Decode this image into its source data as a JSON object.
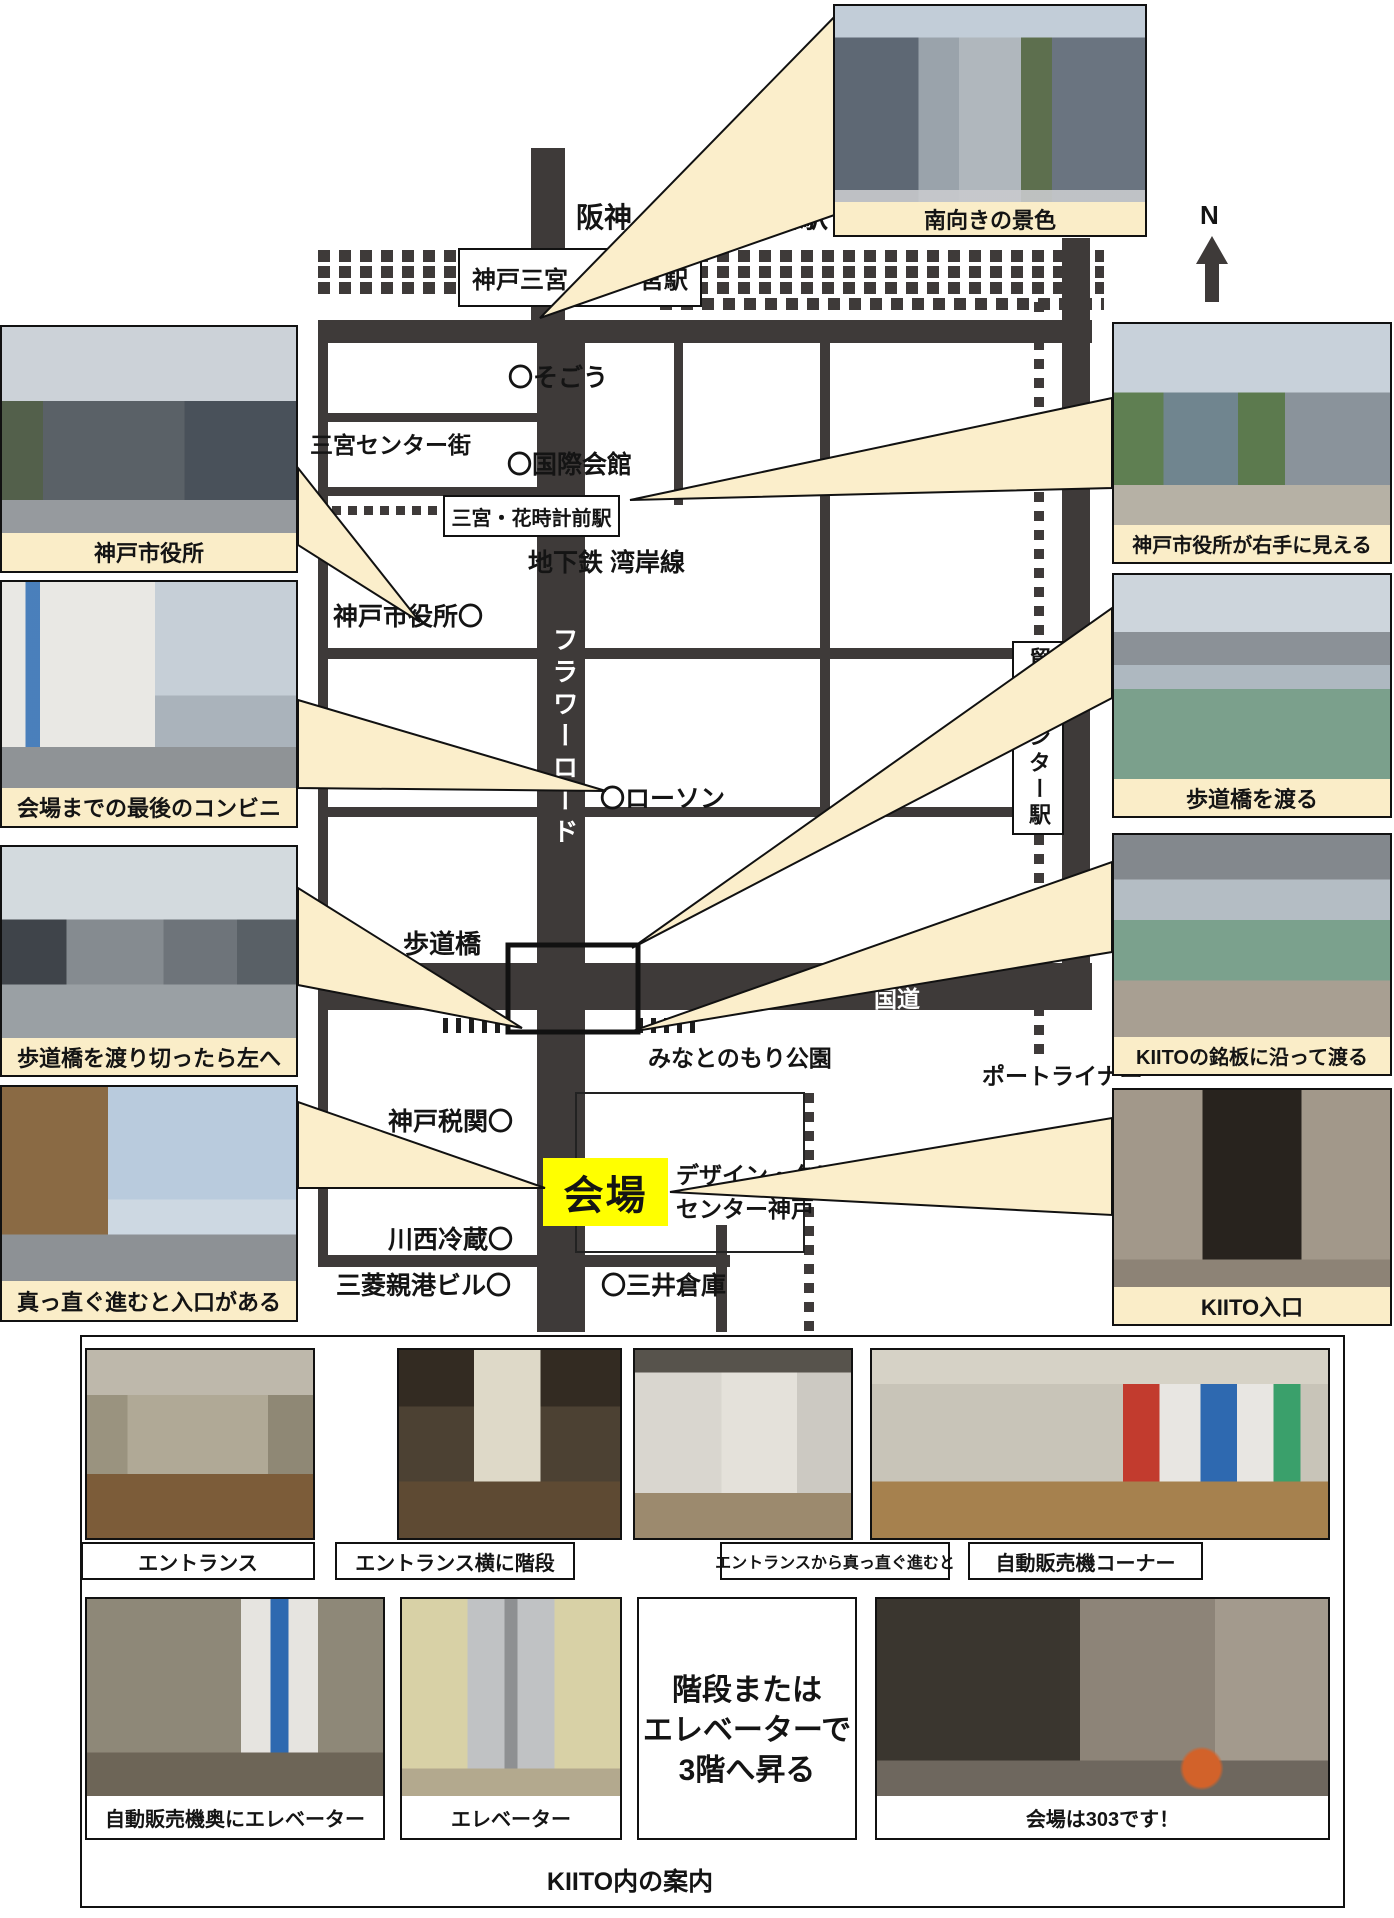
{
  "compass_label": "N",
  "map": {
    "station_top": "阪神・阪急三ノ宮駅",
    "station_sannomiya": "神戸三宮／三ノ宮駅",
    "station_hanadokei": "三宮・花時計前駅",
    "station_boeki": "貿易センター駅",
    "sogo": "〇そごう",
    "sannomiya_center_gai": "三宮センター街",
    "kokusai_kaikan": "〇国際会館",
    "subway_line": "地下鉄 湾岸線",
    "city_hall": "神戸市役所〇",
    "flower_road": "フラワーロード",
    "lawson": "〇ローソン",
    "pedestrian_bridge": "歩道橋",
    "kokudo": "国道",
    "minatonomori_park": "みなとのもり公園",
    "portliner": "ポートライナー",
    "kobe_customs": "神戸税関〇",
    "venue": "会場",
    "design_creative_line1": "デザイン・クリエイティブ",
    "design_creative_line2": "センター神戸",
    "kawanishi_reizo": "川西冷蔵〇",
    "mitsubishi_shinko_bldg": "三菱親港ビル〇",
    "mitsui_soko": "〇三井倉庫"
  },
  "photos": {
    "south_view": {
      "caption": "南向きの景色"
    },
    "left": [
      {
        "caption": "神戸市役所"
      },
      {
        "caption": "会場までの最後のコンビニ"
      },
      {
        "caption": "歩道橋を渡り切ったら左へ"
      },
      {
        "caption": "真っ直ぐ進むと入口がある"
      }
    ],
    "right": [
      {
        "caption": "神戸市役所が右手に見える"
      },
      {
        "caption": "歩道橋を渡る"
      },
      {
        "caption": "KIITOの銘板に沿って渡る"
      },
      {
        "caption": "KIITO入口"
      }
    ]
  },
  "guide": {
    "row1": [
      {
        "caption": "エントランス"
      },
      {
        "caption": "エントランス横に階段"
      },
      {
        "caption": "エントランスから真っ直ぐ進むと"
      },
      {
        "caption": "自動販売機コーナー"
      }
    ],
    "row2": [
      {
        "caption": "自動販売機奥にエレベーター"
      },
      {
        "caption": "エレベーター"
      },
      {
        "caption": "会場は303です！"
      }
    ],
    "stairs_note": [
      "階段または",
      "エレベーターで",
      "3階へ昇る"
    ],
    "footer": "KIITO内の案内"
  },
  "colors": {
    "road": "#3E3A39",
    "callout_fill": "#FBEECB",
    "caption_bg": "#FAEDC8",
    "venue_highlight": "#FFFF00"
  }
}
